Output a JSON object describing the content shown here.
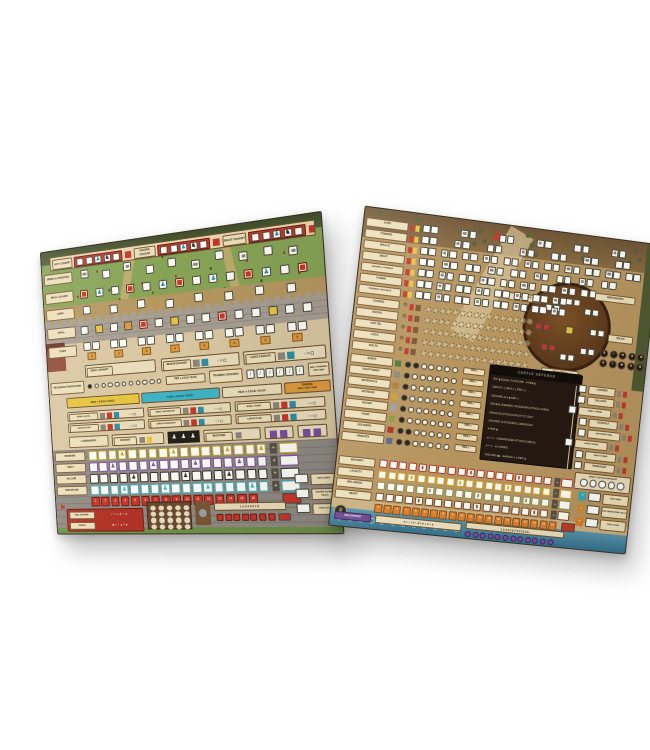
{
  "photo": {
    "background": "#ffffff"
  },
  "left_board": {
    "cohort_banner": {
      "sections": [
        {
          "label": "LEFT COHORT"
        },
        {
          "label": "CENTRE COHORT"
        },
        {
          "label": "RIGHT COHORT"
        }
      ],
      "cells_per_section": 5
    },
    "field_rows": [
      {
        "label": "MINING & FORESTING",
        "cells": "i,w,i,w,w,i,w,i,w,i"
      },
      {
        "label": "WALL GUARD",
        "cells": "r,t,w,r,w,t,r,w,t,w,r,t,w,r"
      },
      {
        "label": "CIPPI",
        "cells": "w,w,w,w,w,w,w,w"
      },
      {
        "label": "WALL",
        "cells": "w,y,w,o,r,w,y,w,w,r,w,w,y,w,w"
      },
      {
        "label": "FORT",
        "fort_numbers": [
          3,
          3,
          3,
          4,
          3,
          4,
          4,
          5
        ]
      }
    ],
    "granaries": [
      {
        "label": "SMALL GRANARY"
      },
      {
        "label": "MEDIUM GRANARY"
      },
      {
        "label": "LARGE GRANARY"
      }
    ],
    "resource_production": {
      "label": "RESOURCE PRODUCTION",
      "dots": 10,
      "note": "PER ● EACH YEAR"
    },
    "training_grounds": {
      "label": "TRAINING GROUNDS",
      "slots": 6,
      "note": "MAX 3 TRAINING PER YEAR"
    },
    "year_strips": [
      {
        "text": "PER ● EACH YEAR",
        "color": "#e6c33f",
        "text_color": "#3a2a10"
      },
      {
        "text": "FOR ● EACH YEAR",
        "color": "#3fb4c4",
        "text_color": "#0d3a40"
      },
      {
        "text": "PER ● EACH YEAR",
        "color": "#e9dcba",
        "text_color": "#3a2a10"
      },
      {
        "title": "TAVERN",
        "text": "MAX 1 PER YEAR",
        "color": "#dd9a3e",
        "text_color": "#3a2508"
      }
    ],
    "building_pairs": [
      {
        "rows": [
          {
            "label": "SMALL HOVEL"
          },
          {
            "label": "LARGE HOVEL"
          }
        ]
      },
      {
        "rows": [
          {
            "label": "SMALL WORKSHOP"
          },
          {
            "label": "LARGE WORKSHOP"
          }
        ]
      },
      {
        "rows": [
          {
            "label": "SMALL ROAD"
          },
          {
            "label": "LARGE ROAD"
          }
        ]
      }
    ],
    "landmark_row": [
      {
        "label": "LANDMARKS"
      },
      {
        "label": "ARCHWAY"
      },
      {
        "label": "MILESTONE"
      }
    ],
    "score_tracks": [
      {
        "label": "RENOWN",
        "color": "#c9a227",
        "cells": 17,
        "markers": [
          3,
          8,
          13,
          16
        ]
      },
      {
        "label": "PIETY",
        "color": "#7b4ea3",
        "cells": 17,
        "markers": [
          2,
          6,
          10,
          14
        ]
      },
      {
        "label": "VALOUR",
        "color": "#35302c",
        "cells": 17,
        "markers": [
          4,
          9,
          13
        ]
      },
      {
        "label": "DISCIPLINE",
        "color": "#3fb4c4",
        "cells": 17,
        "markers": [
          3,
          7,
          11,
          15
        ]
      }
    ],
    "round_track": {
      "start": 1,
      "end": 16,
      "color": "#c7372a"
    },
    "mini_numbers": [
      "1",
      "2",
      "3",
      "4",
      "5",
      "6",
      "7",
      "8"
    ],
    "wall_defense": {
      "label": "WALL DEFENSE",
      "formula": "✓ = ⚔   ✗ = ☠",
      "debase_label": "DEBASE",
      "debase_formula": "◆ = ○   ▲ = ●"
    },
    "summary": [
      {
        "label": "FATE CARDS"
      },
      {
        "label": "DISGRACE (FINAL TALLY)"
      },
      {
        "label": "TOTAL SCORE"
      }
    ]
  },
  "right_board": {
    "build_rows": [
      {
        "label": "GATE",
        "pairs": 6
      },
      {
        "label": "TOWERS",
        "pairs": 7
      },
      {
        "label": "WALLS",
        "pairs": 11
      },
      {
        "label": "MOAT",
        "pairs": 9
      },
      {
        "label": "QUARRY & FOREST",
        "pairs": 9
      },
      {
        "label": "FARMS",
        "pairs": 8
      },
      {
        "label": "TRAINING GROUNDS",
        "pairs": 8
      }
    ],
    "supply_rows": [
      {
        "label": "COVERS",
        "circles": 16
      },
      {
        "label": "ROCKS",
        "circles": 16
      },
      {
        "label": "HOT OIL",
        "circles": 16
      },
      {
        "label": "LOGS",
        "circles": 16
      },
      {
        "label": "BOLTS",
        "circles": 16
      }
    ],
    "people_rows": [
      {
        "label": "SERFS",
        "dots": 7,
        "filled": 2
      },
      {
        "label": "CRAFTSMEN",
        "dots": 7,
        "filled": 1
      },
      {
        "label": "MATERIALS",
        "dots": 7,
        "filled": 1
      },
      {
        "label": "PATRONS",
        "dots": 7,
        "filled": 1
      },
      {
        "label": "SILVER",
        "dots": 7,
        "filled": 1
      },
      {
        "label": "FOOD",
        "dots": 7,
        "filled": 1
      },
      {
        "label": "SOLDIERS",
        "dots": 7,
        "filled": 2
      },
      {
        "label": "KNIGHTS",
        "dots": 7,
        "filled": 2
      }
    ],
    "per_note": "PER ●",
    "castle_defence": {
      "title": "CASTLE DEFENCE",
      "lines": [
        "PAY ▮ EQUAL TO ROUND · ♥ PER ▮",
        "DEPLOY ▯ (MAX 1 ▯ PER ◇)",
        "DISCARD ALL ▮ AND ◇",
        "REVEAL ENEMIES: FACEDOWN ATTACK CARDS",
        "RESOLVE ATTACKS RIGHT TO LEFT",
        "DISCARD SUCCESSFUL DEFENCES",
        "♥ PER ◆",
        "☠ = ⚔ · UNDEFENDED ATTACKS (MIN 0)",
        "♥ = ⚔ · ♛ GAINED",
        "DISCARD ▮▮ · GAINING 1 ● PER ♟"
      ]
    },
    "round_table": {
      "labels": [
        {
          "label": "GUILDSMEN"
        },
        {
          "label": "MERCENARIES"
        },
        {
          "label": "RELICS"
        },
        {
          "label": "SIEGECRAFT"
        }
      ]
    },
    "siege_ladder": [
      {
        "label": "LADDERS"
      },
      {
        "label": "BALLISTA"
      },
      {
        "label": "SMALL CRANE"
      },
      {
        "label": "CATAPULT"
      },
      {
        "label": "BATTERING RAM"
      },
      {
        "label": "LARGE CRANE"
      },
      {
        "label": "SIEGE TOWER"
      },
      {
        "label": "TREBUCHET"
      }
    ],
    "castles_defeated": {
      "label": "ENEMY CASTLES DEFEATED",
      "slots": 5
    },
    "stat_tracks": [
      {
        "label": "BRAVERY",
        "color": "#b23a2c",
        "cells": 18,
        "markers": [
          4,
          9,
          14
        ]
      },
      {
        "label": "LOYALTY",
        "color": "#d4a02a",
        "cells": 18,
        "markers": [
          3,
          8,
          13
        ]
      },
      {
        "label": "INFLUENCE",
        "color": "#8d9159",
        "cells": 18,
        "markers": [
          5,
          10,
          15
        ]
      },
      {
        "label": "MIGHT",
        "color": "#7b4a2e",
        "cells": 18,
        "markers": [
          4,
          10,
          16
        ]
      }
    ],
    "round_track": {
      "start": 1,
      "end": 20,
      "color": "#d87f2e"
    },
    "discontent": {
      "label": "DISCONTENT",
      "formula": "♥ = ○ / ♥ = ✗ / ♥ + ♥ = ●",
      "numbers": [
        "1",
        "2",
        "3",
        "4",
        "5",
        "6",
        "7",
        "8",
        "9",
        "10",
        "12+"
      ],
      "circles": 12
    },
    "summary": [
      {
        "label": "FATE CARDS",
        "sign": "+",
        "color": "#3aa7b0"
      },
      {
        "label": "DISCONTENT (FINAL TALLY)",
        "sign": "−",
        "color": "#c98a3a"
      },
      {
        "label": "TOTAL SCORE",
        "sign": "+",
        "color": "#d87f2e"
      }
    ]
  }
}
